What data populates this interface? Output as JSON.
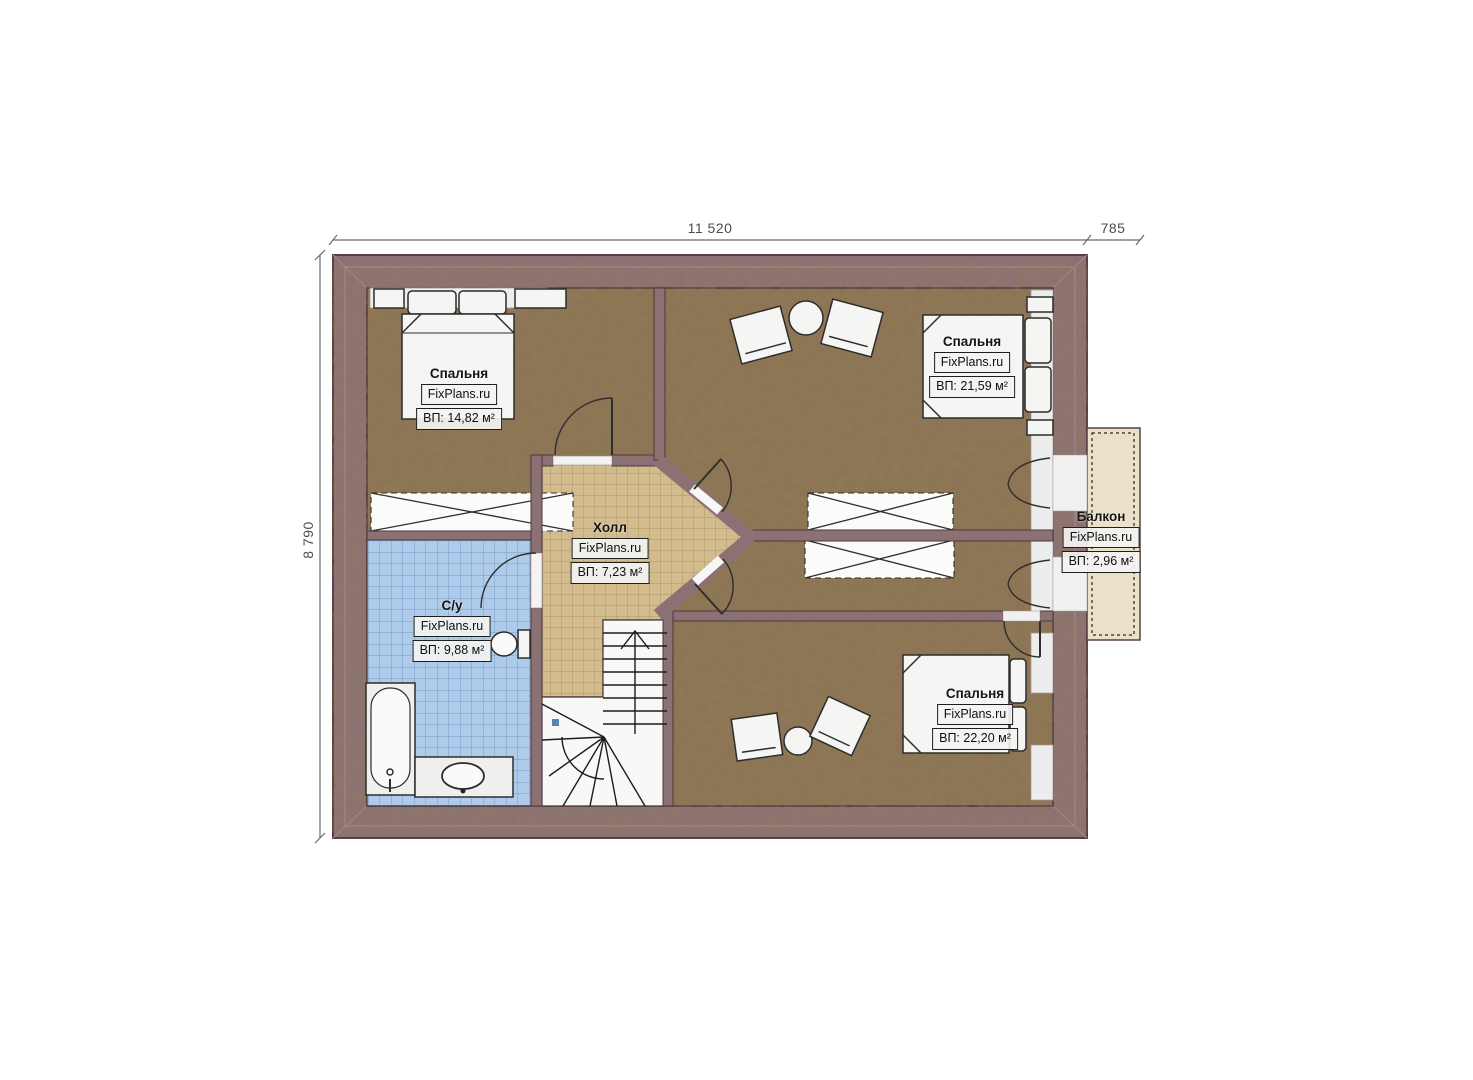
{
  "plan": {
    "kind": "attic-floor-plan",
    "dimensions": {
      "top_main": "11 520",
      "top_balcony": "785",
      "left_total": "8 790"
    },
    "rooms": [
      {
        "key": "bedroom-top-left",
        "name": "Спальня",
        "brand": "FixPlans.ru",
        "area": "ВП: 14,82 м²"
      },
      {
        "key": "bedroom-top-right",
        "name": "Спальня",
        "brand": "FixPlans.ru",
        "area": "ВП: 21,59 м²"
      },
      {
        "key": "hall",
        "name": "Холл",
        "brand": "FixPlans.ru",
        "area": "ВП: 7,23 м²"
      },
      {
        "key": "bathroom",
        "name": "С/у",
        "brand": "FixPlans.ru",
        "area": "ВП: 9,88 м²"
      },
      {
        "key": "balcony",
        "name": "Балкон",
        "brand": "FixPlans.ru",
        "area": "ВП: 2,96 м²"
      },
      {
        "key": "bedroom-bottom-right",
        "name": "Спальня",
        "brand": "FixPlans.ru",
        "area": "ВП: 22,20 м²"
      }
    ],
    "colors": {
      "wall": "#8c7174",
      "wall_outline": "#554144",
      "floor": "#8c7454",
      "hall_floor": "#d2bc8e",
      "bathroom_floor": "#aecbe9",
      "balcony_floor": "#ebe1c9",
      "stair_fill": "#f8f8f6",
      "furniture_fill": "#f5f5f3",
      "accent_marker": "#5b82b5"
    }
  }
}
